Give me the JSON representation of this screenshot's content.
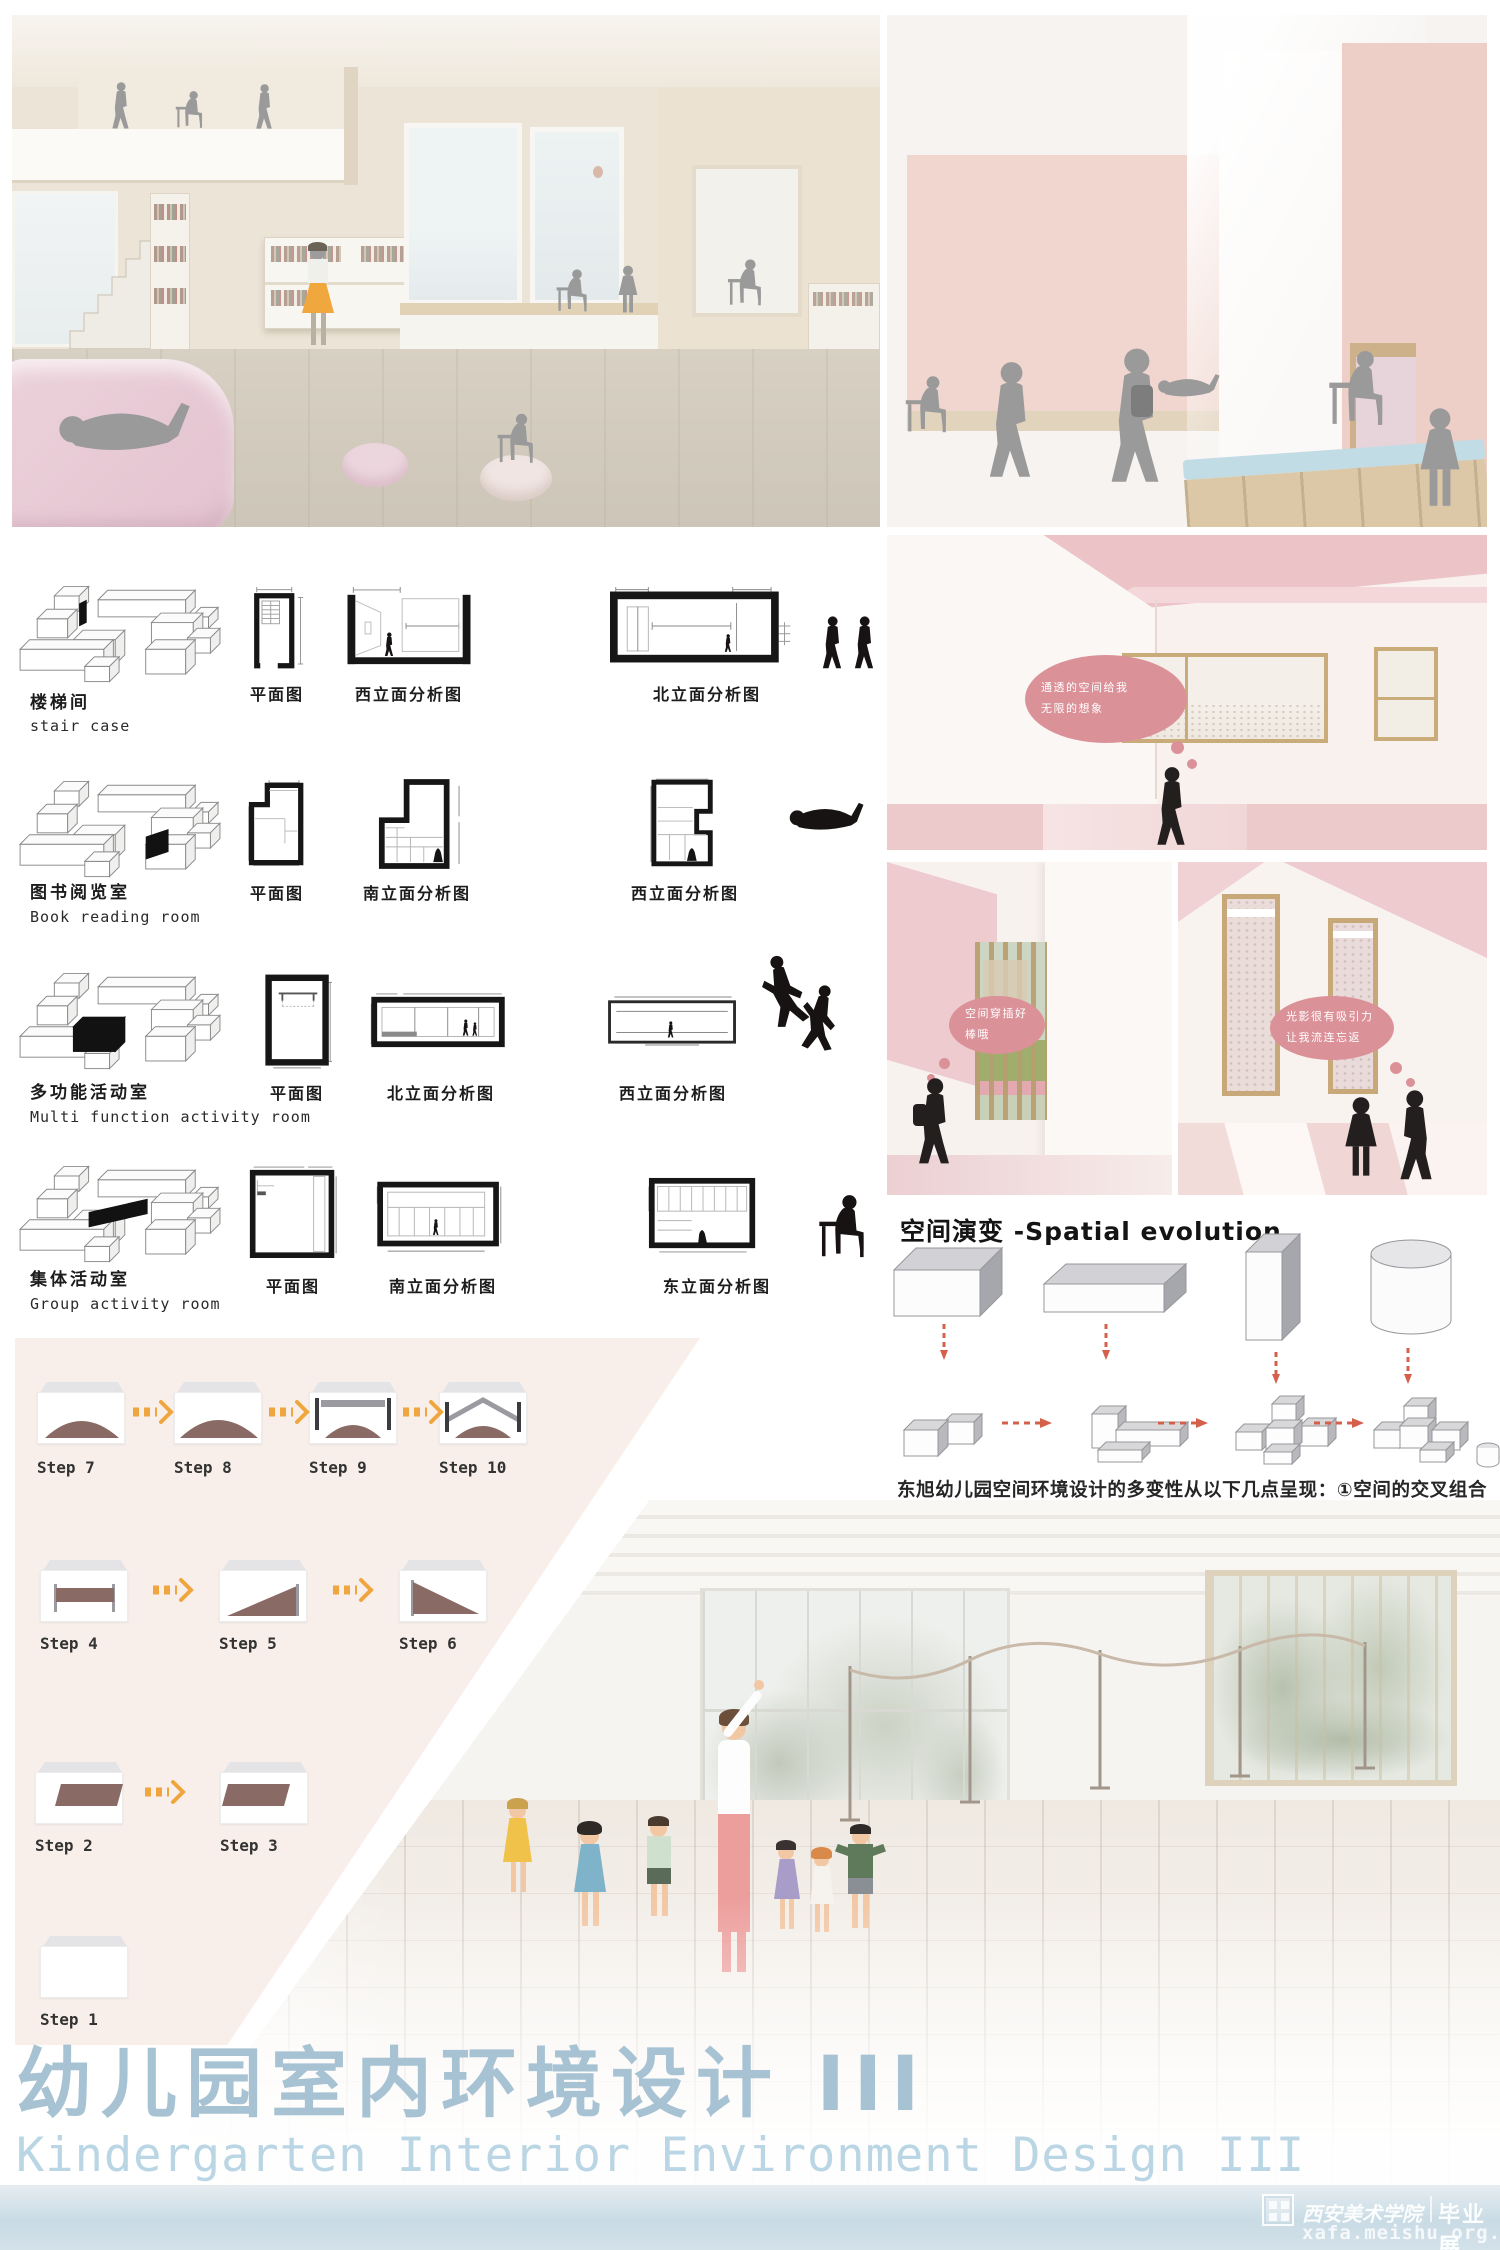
{
  "poster": {
    "title_zh": "幼儿园室内环境设计 III",
    "title_en": "Kindergarten Interior Environment Design III"
  },
  "watermark": {
    "school": "西安美术学院",
    "label": "毕业展",
    "url": "xafa.meishu.org.cn"
  },
  "rooms": [
    {
      "name_zh": "楼梯间",
      "name_en": "stair case",
      "diagrams": [
        "平面图",
        "西立面分析图",
        "北立面分析图"
      ]
    },
    {
      "name_zh": "图书阅览室",
      "name_en": "Book reading room",
      "diagrams": [
        "平面图",
        "南立面分析图",
        "西立面分析图"
      ]
    },
    {
      "name_zh": "多功能活动室",
      "name_en": "Multi function activity room",
      "diagrams": [
        "平面图",
        "北立面分析图",
        "西立面分析图"
      ]
    },
    {
      "name_zh": "集体活动室",
      "name_en": "Group activity room",
      "diagrams": [
        "平面图",
        "南立面分析图",
        "东立面分析图"
      ]
    }
  ],
  "bubbles": {
    "b1": {
      "line1": "通透的空间给我",
      "line2": "无限的想象"
    },
    "b2": {
      "line1": "空间穿插好",
      "line2": "棒哦"
    },
    "b3": {
      "line1": "光影很有吸引力",
      "line2": "让我流连忘返"
    }
  },
  "evolution": {
    "heading": "空间演变 -Spatial evolution",
    "paragraph": "东旭幼儿园空间环境设计的多变性从以下几点呈现：①空间的交叉组合与对比，高大开放与低矮封闭的空间组合，因此将不同的空间形体进行转变创造建筑空间的灵活性②空间的复制循环与再现，一样的空间组合状态在不同的空间环境中无限的重复改变，营造出有趣的空间环境组合方式，创设具有重复性又有音律变化的多维度空间组成效果。这种方法给人强烈的空间节奏感。"
  },
  "steps": {
    "row1": [
      "Step 7",
      "Step 8",
      "Step 9",
      "Step 10"
    ],
    "row2": [
      "Step 4",
      "Step 5",
      "Step 6"
    ],
    "row3": [
      "Step 2",
      "Step 3"
    ],
    "row4": [
      "Step 1"
    ]
  },
  "colors": {
    "accent_pink": "#db9198",
    "panel_pink": "#f8efeb",
    "arrow_orange": "#f0a63e",
    "arrow_red": "#d4604c",
    "title_blue": "#a7c3d3",
    "subtitle_blue": "#bad6e4",
    "render_pink_wall": "#efd0cb",
    "diagram_black": "#161616",
    "step_brown": "#8a6a64"
  }
}
